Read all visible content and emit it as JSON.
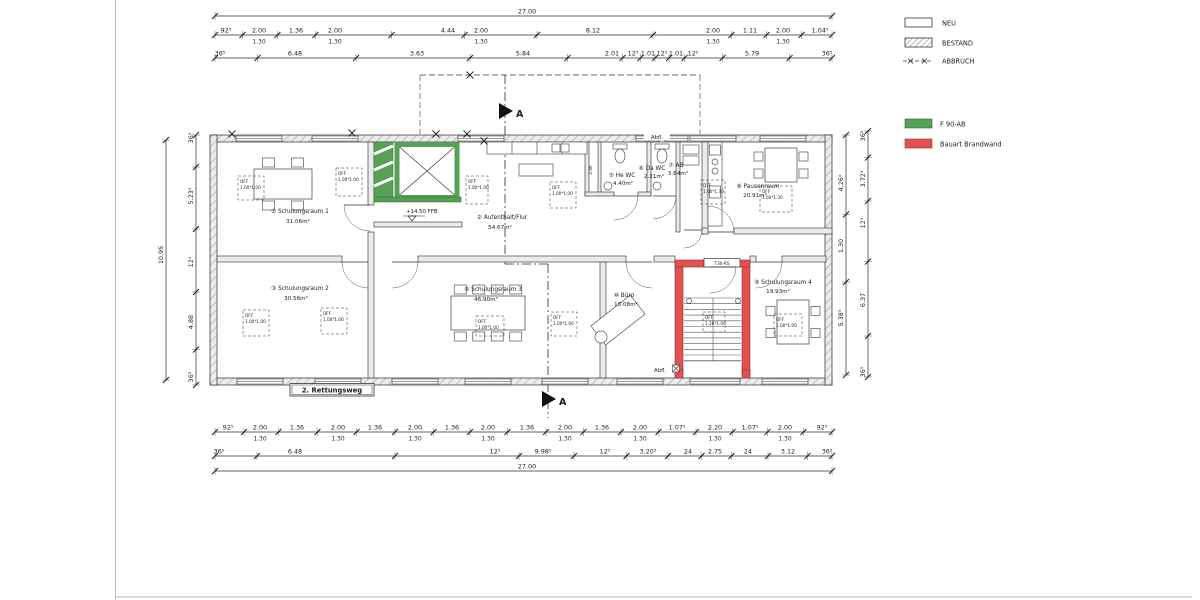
{
  "legend": {
    "neu": "NEU",
    "bestand": "BESTAND",
    "abbruch": "ABBRUCH",
    "f90": "F 90-AB",
    "brandwand": "Bauart Brandwand"
  },
  "colors": {
    "green": "#57a057",
    "red": "#e05150",
    "wall_fill": "#ebebeb",
    "hatch_line": "#9b9b9b"
  },
  "rooms": {
    "schulungsraum1": {
      "name": "① Schulungsraum 1",
      "area": "31.06m²"
    },
    "aufenthalt": {
      "name": "② Aufenthalt/Flur",
      "area": "54.67m²"
    },
    "schulungsraum2": {
      "name": "③ Schulungsraum 2",
      "area": "30.56m²"
    },
    "schulungsraum3": {
      "name": "④ Schulungsraum 3",
      "area": "46.90m²"
    },
    "he_wc": {
      "name": "⑤ He WC",
      "area": "4.40m²"
    },
    "da_wc": {
      "name": "⑥ Da WC",
      "area": "2.21m²"
    },
    "ab": {
      "name": "⑦ AB",
      "area": "3.64m²"
    },
    "pausenraum": {
      "name": "⑧ Pausenraum",
      "area": "20.91m²"
    },
    "schulungsraum4": {
      "name": "⑨ Schulungsraum 4",
      "area": "19.93m²"
    },
    "buero": {
      "name": "⑩ Büro",
      "area": "15.08m²"
    }
  },
  "annotations": {
    "level": "+14.50 FFB",
    "abfl_top": "Abfl.",
    "abfl_bottom": "Abfl.",
    "rettungsweg": "2. Rettungsweg",
    "door_label": "T30-RS",
    "section_top": "A",
    "section_bottom": "A",
    "vorraum_dim": "2.06",
    "off_line1": "OFF",
    "off_line2": "1.00*1.00",
    "dtf_line1": "DTF",
    "dtf_line2": "1.00*1.30",
    "off130_line2": "1.00*1.30",
    "stair_off_line1": "OFF",
    "stair_off_line2": "1.26*1.00"
  },
  "dims": {
    "top": [
      {
        "name": "top-total",
        "orient": "h",
        "y": 16,
        "x1": 215,
        "x2": 832,
        "items": [
          {
            "x": 527,
            "v": "27.00"
          }
        ]
      },
      {
        "name": "top-row1",
        "orient": "h",
        "y": 35,
        "x1": 215,
        "x2": 832,
        "items": [
          {
            "x": 226,
            "v": "92⁵"
          },
          {
            "x": 259,
            "v": "2.00",
            "sub": "1.30"
          },
          {
            "x": 296,
            "v": "1.36"
          },
          {
            "x": 335,
            "v": "2.00",
            "sub": "1.30"
          },
          {
            "x": 448,
            "v": "4.44"
          },
          {
            "x": 481,
            "v": "2.00",
            "sub": "1.30"
          },
          {
            "x": 593,
            "v": "8.12"
          },
          {
            "x": 713,
            "v": "2.00",
            "sub": "1.30"
          },
          {
            "x": 750,
            "v": "1.11"
          },
          {
            "x": 783,
            "v": "2.00",
            "sub": "1.30"
          },
          {
            "x": 820,
            "v": "1.04⁵"
          }
        ]
      },
      {
        "name": "top-row2",
        "orient": "h",
        "y": 58,
        "x1": 215,
        "x2": 832,
        "items": [
          {
            "x": 220,
            "v": "36⁵"
          },
          {
            "x": 295,
            "v": "6.48"
          },
          {
            "x": 417,
            "v": "3.63"
          },
          {
            "x": 523,
            "v": "5.84"
          },
          {
            "x": 612,
            "v": "2.01"
          },
          {
            "x": 633,
            "v": "12⁵"
          },
          {
            "x": 648,
            "v": "1.01"
          },
          {
            "x": 662,
            "v": "12⁵"
          },
          {
            "x": 676,
            "v": "1.01"
          },
          {
            "x": 693,
            "v": "12⁵"
          },
          {
            "x": 752,
            "v": "5.79"
          },
          {
            "x": 827,
            "v": "36⁵"
          }
        ]
      }
    ],
    "bottom": [
      {
        "name": "bottom-row1",
        "orient": "h",
        "y": 432,
        "x1": 215,
        "x2": 832,
        "items": [
          {
            "x": 228,
            "v": "92⁵"
          },
          {
            "x": 260,
            "v": "2.00",
            "sub": "1.30"
          },
          {
            "x": 297,
            "v": "1.36"
          },
          {
            "x": 338,
            "v": "2.00",
            "sub": "1.30"
          },
          {
            "x": 375,
            "v": "1.36"
          },
          {
            "x": 415,
            "v": "2.00",
            "sub": "1.30"
          },
          {
            "x": 452,
            "v": "1.36"
          },
          {
            "x": 488,
            "v": "2.00",
            "sub": "1.30"
          },
          {
            "x": 527,
            "v": "1.36"
          },
          {
            "x": 565,
            "v": "2.00",
            "sub": "1.30"
          },
          {
            "x": 602,
            "v": "1.36"
          },
          {
            "x": 640,
            "v": "2.00",
            "sub": "1.30"
          },
          {
            "x": 677,
            "v": "1.07⁵"
          },
          {
            "x": 715,
            "v": "2.20",
            "sub": "1.30"
          },
          {
            "x": 750,
            "v": "1.07⁵"
          },
          {
            "x": 785,
            "v": "2.00",
            "sub": "1.30"
          },
          {
            "x": 822,
            "v": "92⁵"
          }
        ]
      },
      {
        "name": "bottom-row2",
        "orient": "h",
        "y": 456,
        "x1": 215,
        "x2": 832,
        "items": [
          {
            "x": 219,
            "v": "36⁵"
          },
          {
            "x": 295,
            "v": "6.48"
          },
          {
            "x": 495,
            "v": "12⁵"
          },
          {
            "x": 543,
            "v": "9.98⁵"
          },
          {
            "x": 605,
            "v": "12⁵"
          },
          {
            "x": 648,
            "v": "3.20⁵"
          },
          {
            "x": 688,
            "v": "24"
          },
          {
            "x": 715,
            "v": "2.75"
          },
          {
            "x": 748,
            "v": "24"
          },
          {
            "x": 788,
            "v": "3.12"
          },
          {
            "x": 827,
            "v": "36⁵"
          }
        ]
      },
      {
        "name": "bottom-total",
        "orient": "h",
        "y": 471,
        "x1": 215,
        "x2": 832,
        "items": [
          {
            "x": 527,
            "v": "27.00"
          }
        ]
      }
    ],
    "left": [
      {
        "name": "left-col1",
        "orient": "v",
        "x": 166,
        "y1": 140,
        "y2": 380,
        "items": [
          {
            "y": 255,
            "v": "10.95"
          }
        ]
      },
      {
        "name": "left-col2",
        "orient": "v",
        "x": 196,
        "y1": 135,
        "y2": 385,
        "items": [
          {
            "y": 138,
            "v": "36⁵"
          },
          {
            "y": 196,
            "v": "5.23⁵"
          },
          {
            "y": 262,
            "v": "12⁵"
          },
          {
            "y": 322,
            "v": "4.88"
          },
          {
            "y": 377,
            "v": "36⁵"
          }
        ]
      }
    ],
    "right": [
      {
        "name": "right-col1",
        "orient": "v",
        "x": 846,
        "y1": 135,
        "y2": 375,
        "items": [
          {
            "y": 183,
            "v": "4.26⁵"
          },
          {
            "y": 246,
            "v": "1.30"
          },
          {
            "y": 318,
            "v": "5.38⁵"
          }
        ]
      },
      {
        "name": "right-col2",
        "orient": "v",
        "x": 868,
        "y1": 131,
        "y2": 377,
        "items": [
          {
            "y": 136,
            "v": "36⁵"
          },
          {
            "y": 179,
            "v": "3.72⁵"
          },
          {
            "y": 223,
            "v": "12⁵"
          },
          {
            "y": 300,
            "v": "6.37"
          },
          {
            "y": 372,
            "v": "36⁵"
          }
        ]
      }
    ]
  }
}
